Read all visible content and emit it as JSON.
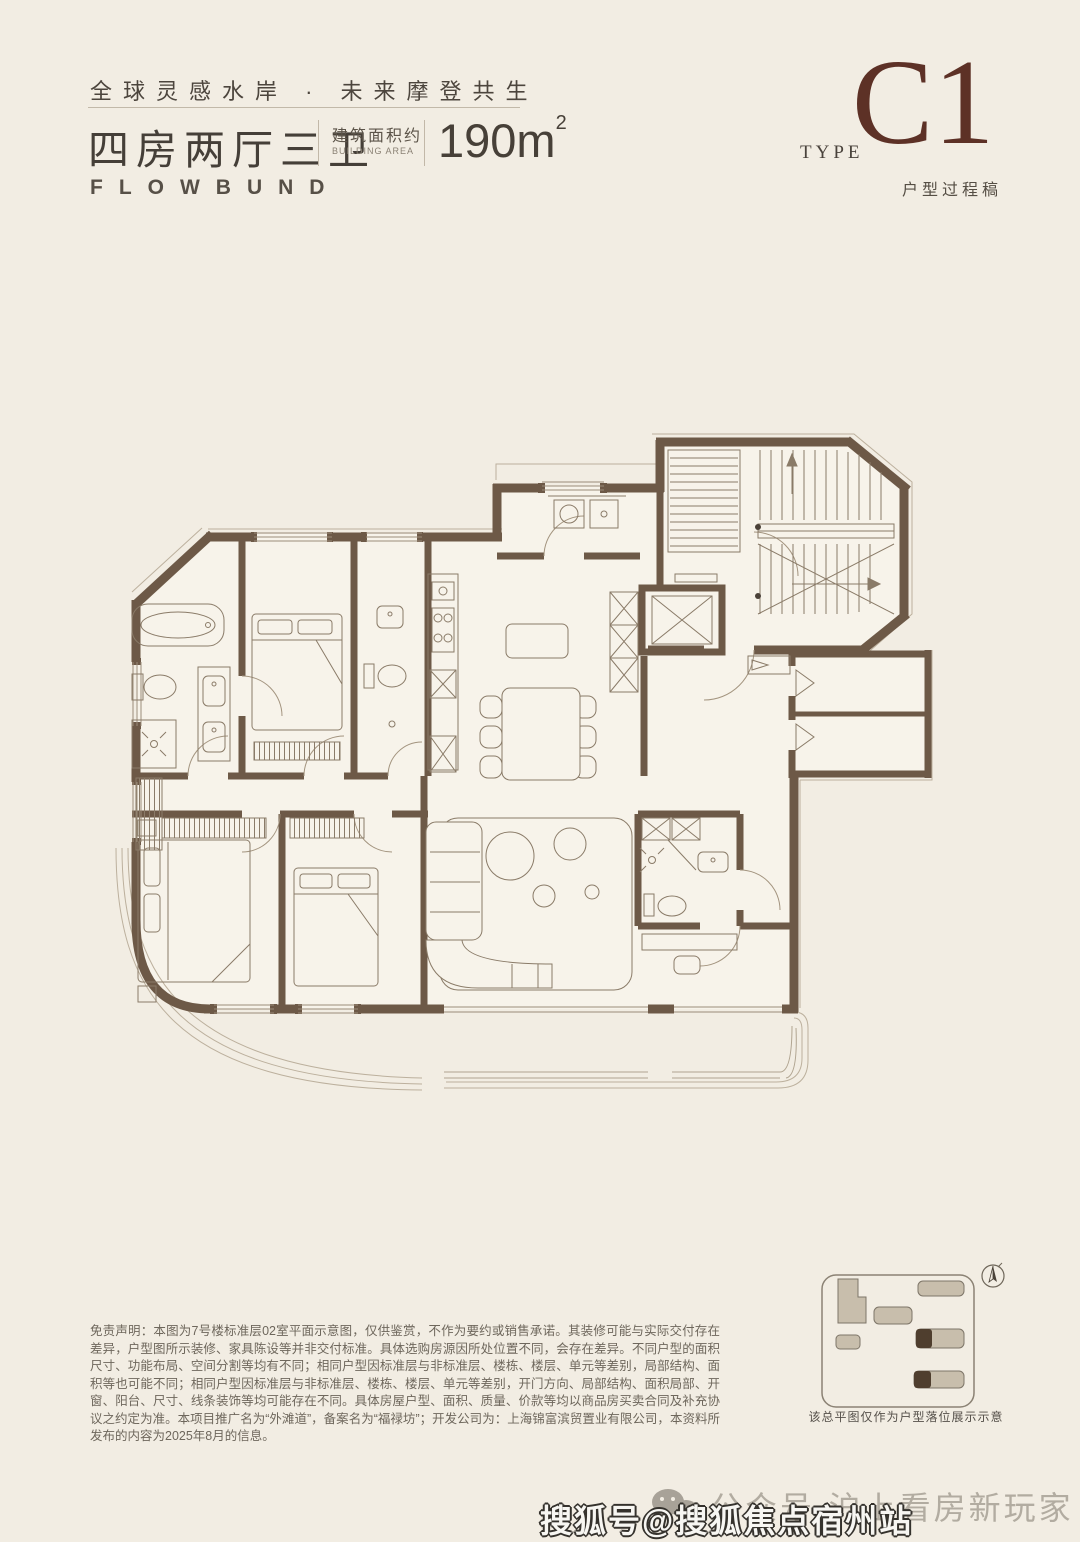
{
  "header": {
    "tagline": "全球灵感水岸 · 未来摩登共生",
    "unit_layout": "四房两厅三卫",
    "area_label_cn": "建筑面积约",
    "area_label_en": "BUILDING AREA",
    "area_value": "190m",
    "area_sup": "2",
    "brand": "FLOWBUND"
  },
  "type_badge": {
    "type_label": "TYPE",
    "type_code": "C1",
    "type_note": "户型过程稿"
  },
  "disclaimer": {
    "text": "免责声明：本图为7号楼标准层02室平面示意图，仅供鉴赏，不作为要约或销售承诺。其装修可能与实际交付存在差异，户型图所示装修、家具陈设等并非交付标准。具体选购房源因所处位置不同，会存在差异。不同户型的面积尺寸、功能布局、空间分割等均有不同；相同户型因标准层与非标准层、楼栋、楼层、单元等差别，局部结构、面积等也可能不同；相同户型因标准层与非标准层、楼栋、楼层、单元等差别，开门方向、局部结构、面积局部、开窗、阳台、尺寸、线条装饰等均可能存在不同。具体房屋户型、面积、质量、价款等均以商品房买卖合同及补充协议之约定为准。本项目推广名为“外滩道”，备案名为“福禄坊”；开发公司为：上海锦富滨贸置业有限公司，本资料所发布的内容为2025年8月的信息。"
  },
  "site_plan": {
    "caption": "该总平图仅作为户型落位展示示意"
  },
  "watermark": {
    "wechat_account": "公众号·沪上看房新玩家",
    "sohu_account": "搜狐号@搜狐焦点宿州站"
  },
  "colors": {
    "paper": "#f2ede3",
    "wall_brown": "#6d5947",
    "accent_maroon": "#5d3126",
    "text_dark": "#46403a",
    "text_muted": "#6e675c"
  }
}
